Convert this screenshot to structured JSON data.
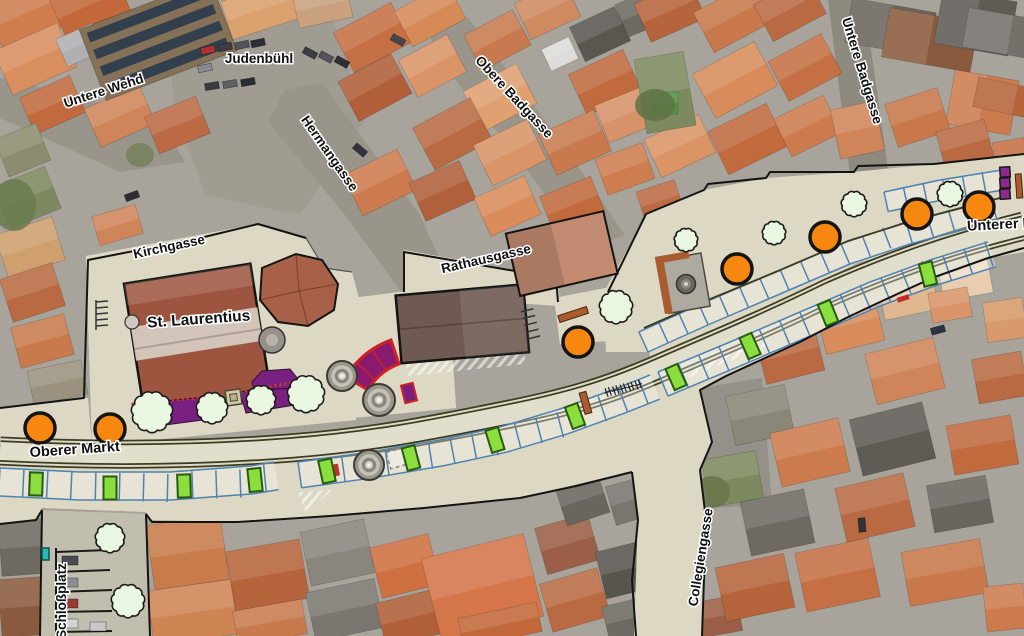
{
  "page": {
    "type": "aerial-photo-with-redevelopment-plan-overlay",
    "locale": "de"
  },
  "colors": {
    "plan_surface": "#dcd8c3",
    "road_edge_olive": "#3c3c22",
    "parking_outline_blue": "#4f82b0",
    "planned_tree_orange": "#f6870f",
    "planned_tree_outline": "#141414",
    "existing_tree_green": "#e9f7e1",
    "existing_tree_outline": "#1b1b1b",
    "green_stall_fill": "#8ade3e",
    "green_stall_outline": "#2a5a12",
    "planting_bed_purple": "#7a2080",
    "bed_border_red": "#cc3a22",
    "stair_fill": "#8a1a6e",
    "stair_border": "#cc2222",
    "bench_brown": "#a85c30",
    "label_color": "#101010",
    "label_halo": "#ffffff"
  },
  "map": {
    "labels": [
      {
        "text": "Untere Wehd",
        "x": 105,
        "y": 95,
        "rot": -18
      },
      {
        "text": "Judenbühl",
        "x": 259,
        "y": 63,
        "rot": 0
      },
      {
        "text": "Hermangasse",
        "x": 326,
        "y": 156,
        "rot": 55
      },
      {
        "text": "Obere Badgasse",
        "x": 511,
        "y": 100,
        "rot": 47
      },
      {
        "text": "Untere Badgasse",
        "x": 858,
        "y": 72,
        "rot": 73
      },
      {
        "text": "Kirchgasse",
        "x": 170,
        "y": 251,
        "rot": -12
      },
      {
        "text": "St. Laurentius",
        "x": 199,
        "y": 324,
        "rot": -4
      },
      {
        "text": "Rathausgasse",
        "x": 487,
        "y": 263,
        "rot": -13
      },
      {
        "text": "Unterer M",
        "x": 1001,
        "y": 229,
        "rot": -3
      },
      {
        "text": "Oberer Markt",
        "x": 75,
        "y": 454,
        "rot": -4
      },
      {
        "text": "Schloßplatz",
        "x": 66,
        "y": 601,
        "rot": -90
      },
      {
        "text": "Collegiengasse",
        "x": 705,
        "y": 558,
        "rot": -81
      }
    ],
    "features": {
      "planned_trees": [
        [
          40,
          428
        ],
        [
          110,
          429
        ],
        [
          578,
          342
        ],
        [
          737,
          269
        ],
        [
          825,
          237
        ],
        [
          917,
          214
        ],
        [
          979,
          207
        ]
      ],
      "existing_trees": [
        [
          152,
          412,
          21
        ],
        [
          212,
          408,
          16
        ],
        [
          261,
          400,
          15
        ],
        [
          306,
          394,
          19
        ],
        [
          616,
          307,
          17
        ],
        [
          686,
          240,
          12
        ],
        [
          774,
          233,
          12
        ],
        [
          854,
          204,
          13
        ],
        [
          950,
          194,
          13
        ],
        [
          110,
          538,
          15
        ],
        [
          128,
          601,
          17
        ]
      ],
      "green_stalls": [
        [
          36,
          484,
          2
        ],
        [
          110,
          488,
          0
        ],
        [
          184,
          486,
          -2
        ],
        [
          255,
          480,
          -6
        ],
        [
          327,
          471,
          -12
        ],
        [
          411,
          458,
          -15
        ],
        [
          495,
          440,
          -17
        ],
        [
          575,
          416,
          -20
        ],
        [
          676,
          377,
          -24
        ],
        [
          750,
          346,
          -24
        ],
        [
          828,
          313,
          -22
        ],
        [
          928,
          274,
          -14
        ]
      ],
      "fountains": [
        [
          342,
          376,
          15
        ],
        [
          379,
          400,
          16
        ],
        [
          369,
          465,
          15
        ]
      ],
      "purple_markers": [
        [
          1005,
          172
        ],
        [
          1005,
          183
        ],
        [
          1005,
          194
        ]
      ]
    }
  }
}
